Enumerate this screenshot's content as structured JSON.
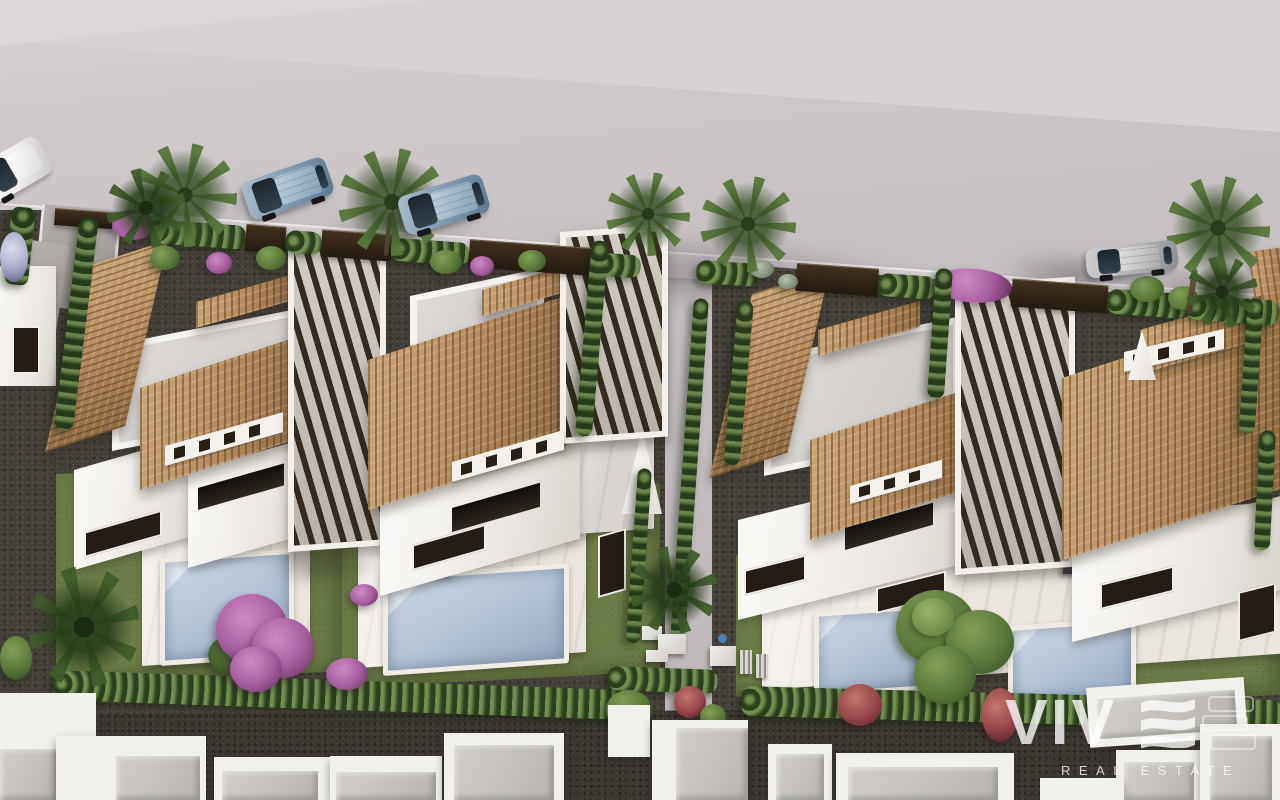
{
  "watermark": {
    "brand_name": "VIVE",
    "brand_display_prefix": "VIV",
    "tagline": "REAL ESTATE"
  },
  "palette": {
    "asphalt": "#c7c1c3",
    "asphalt_light": "#d8d2d3",
    "sidewalk": "#d5cfd0",
    "gravel": "#45403a",
    "lawn": "#6e7e49",
    "hedge": "#4a5f36",
    "roof_tile": "#b2885a",
    "roof_tile_light": "#cba676",
    "roof_tile_dark": "#8f6c44",
    "villa_wall": "#f4f2ef",
    "deck": "#eae5dd",
    "pool_water": "#b5c3d5",
    "pergola_slat": "#30261c",
    "car_blue": "#7d97ae",
    "car_silver": "#b4b4b6",
    "car_white": "#efedee",
    "flower_purple": "#a75f9f",
    "flower_red": "#96454b",
    "tree_green": "#5d7742",
    "watermark_white": "#ffffff"
  },
  "scene": {
    "description": "Aerial 3D render of white villas with terracotta tile roofs, pergolas, private pools and gardens along a street with parked cars",
    "villas_visible": 4,
    "pools_visible": 4,
    "cars_parked": 4,
    "street_palm_trees": 6
  }
}
